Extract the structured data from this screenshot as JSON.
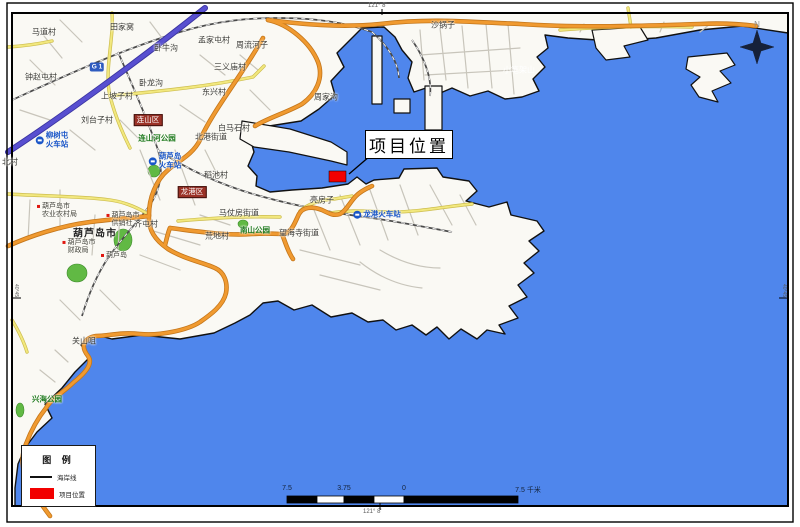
{
  "map": {
    "callout": {
      "label": "项目位置"
    },
    "legend": {
      "title": "图 例",
      "items": [
        {
          "label": "海岸线",
          "type": "line"
        },
        {
          "label": "项目位置",
          "type": "rect"
        }
      ]
    },
    "scalebar": {
      "labels": [
        "7.5",
        "3.75",
        "0",
        "7.5 千米"
      ]
    },
    "compass": {
      "label": "N"
    },
    "coordinates": {
      "top": "121° 8'",
      "bottom": "121° 8'",
      "left": "40°45'",
      "right": "40°45'"
    },
    "labels": [
      {
        "t": "马道村",
        "x": 44,
        "y": 32
      },
      {
        "t": "田家窝",
        "x": 122,
        "y": 27
      },
      {
        "t": "孟家屯村",
        "x": 214,
        "y": 40
      },
      {
        "t": "周流河子",
        "x": 252,
        "y": 45
      },
      {
        "t": "卧牛沟",
        "x": 166,
        "y": 48
      },
      {
        "t": "三义庙村",
        "x": 230,
        "y": 67
      },
      {
        "t": "卧龙沟",
        "x": 151,
        "y": 83
      },
      {
        "t": "东兴村",
        "x": 214,
        "y": 92
      },
      {
        "t": "钟赵屯村",
        "x": 41,
        "y": 77
      },
      {
        "t": "上坡子村",
        "x": 117,
        "y": 96
      },
      {
        "t": "刘台子村",
        "x": 97,
        "y": 120
      },
      {
        "t": "白马石村",
        "x": 234,
        "y": 128
      },
      {
        "t": "北港街道",
        "x": 211,
        "y": 137
      },
      {
        "t": "稻池村",
        "x": 216,
        "y": 175
      },
      {
        "t": "齐屯村",
        "x": 146,
        "y": 224
      },
      {
        "t": "荒地村",
        "x": 217,
        "y": 236
      },
      {
        "t": "马仗房街道",
        "x": 239,
        "y": 213
      },
      {
        "t": "望海寺街道",
        "x": 299,
        "y": 233
      },
      {
        "t": "亮房子",
        "x": 322,
        "y": 200
      },
      {
        "t": "沙锅子",
        "x": 443,
        "y": 25
      },
      {
        "t": "周家沟",
        "x": 326,
        "y": 97
      },
      {
        "t": "北村",
        "x": 10,
        "y": 162
      },
      {
        "t": "关山咀",
        "x": 84,
        "y": 341
      },
      {
        "t": "葫芦岛市",
        "x": 95,
        "y": 234,
        "c": "city"
      },
      {
        "t": "葫芦岛市\n农业农村局",
        "x": 57,
        "y": 211,
        "c": "poi",
        "dot": 1
      },
      {
        "t": "葫芦岛市\n供销社",
        "x": 123,
        "y": 220,
        "c": "poi",
        "dot": 1
      },
      {
        "t": "葫芦岛市\n财政局",
        "x": 79,
        "y": 247,
        "c": "poi",
        "dot": 1
      },
      {
        "t": "葫芦岛",
        "x": 114,
        "y": 256,
        "c": "poi",
        "dot": 1
      },
      {
        "t": "柳树屯\n火车站",
        "x": 52,
        "y": 140,
        "c": "station",
        "icon": 1
      },
      {
        "t": "葫芦岛\n火车站",
        "x": 165,
        "y": 161,
        "c": "station",
        "icon": 1
      },
      {
        "t": "龙港火车站",
        "x": 377,
        "y": 215,
        "c": "station",
        "icon": 1
      },
      {
        "t": "连山河公园",
        "x": 157,
        "y": 139,
        "c": "park"
      },
      {
        "t": "南山公园",
        "x": 255,
        "y": 231,
        "c": "park"
      },
      {
        "t": "兴海公园",
        "x": 47,
        "y": 400,
        "c": "park"
      },
      {
        "t": "小笔架山",
        "x": 519,
        "y": 70,
        "c": "sea"
      },
      {
        "t": "连山区",
        "x": 148,
        "y": 120,
        "c": "badge-red"
      },
      {
        "t": "龙港区",
        "x": 192,
        "y": 192,
        "c": "badge-red"
      },
      {
        "t": "G 1",
        "x": 97,
        "y": 67,
        "c": "badge-blue"
      }
    ]
  },
  "colors": {
    "sea": "#4f86ec",
    "land": "#faf9f4",
    "coastline": "#111111",
    "road_orange": "#f09a30",
    "road_orange_casing": "#c4761a",
    "road_yellow": "#f2e87e",
    "road_yellow_casing": "#cdbd4e",
    "expressway": "#584fd0",
    "railway": "#4a4a4a",
    "park_green": "#61b944",
    "project_red": "#f20000",
    "badge_red": "#9b3227",
    "station_blue": "#1a56c8"
  }
}
